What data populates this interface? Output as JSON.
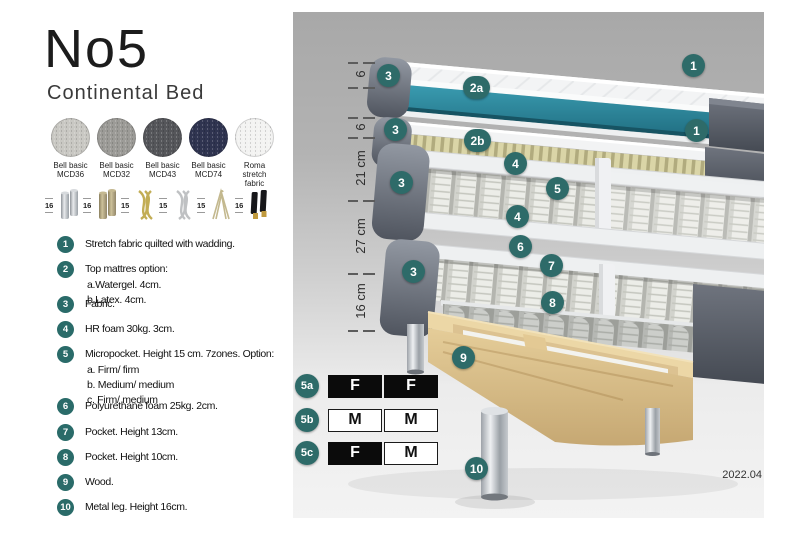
{
  "header": {
    "title": "No5",
    "subtitle": "Continental Bed"
  },
  "fabrics": {
    "items": [
      {
        "line1": "Bell basic",
        "line2": "MCD36",
        "color": "#c9c8c3"
      },
      {
        "line1": "Bell basic",
        "line2": "MCD32",
        "color": "#9c9b97"
      },
      {
        "line1": "Bell basic",
        "line2": "MCD43",
        "color": "#55565a"
      },
      {
        "line1": "Bell basic",
        "line2": "MCD74",
        "color": "#2f3450"
      },
      {
        "line1": "Roma",
        "line2": "stretch fabric",
        "color": "#f3f3f2"
      }
    ]
  },
  "legs": {
    "items": [
      {
        "height": "16",
        "style": "cylinder-silver"
      },
      {
        "height": "16",
        "style": "cylinder-brass"
      },
      {
        "height": "15",
        "style": "twisted-gold"
      },
      {
        "height": "15",
        "style": "twisted-silver"
      },
      {
        "height": "15",
        "style": "hairpin"
      },
      {
        "height": "16",
        "style": "black-gold-tip"
      }
    ]
  },
  "legend": {
    "items": [
      {
        "num": "1",
        "text": "Stretch fabric quilted with wadding."
      },
      {
        "num": "2",
        "text": "Top mattres option:",
        "subs": [
          "a.Watergel. 4cm.",
          "b.Latex. 4cm."
        ]
      },
      {
        "num": "3",
        "text": "Fabric."
      },
      {
        "num": "4",
        "text": "HR foam 30kg. 3cm."
      },
      {
        "num": "5",
        "text": "Micropocket. Height 15 cm. 7zones. Option:",
        "subs": [
          "a. Firm/ firm",
          "b. Medium/ medium",
          "c. Firm/ medium"
        ]
      },
      {
        "num": "6",
        "text": "Polyurethane foam 25kg. 2cm."
      },
      {
        "num": "7",
        "text": "Pocket. Height 13cm."
      },
      {
        "num": "8",
        "text": "Pocket. Height 10cm."
      },
      {
        "num": "9",
        "text": "Wood."
      },
      {
        "num": "10",
        "text": "Metal leg. Height 16cm."
      }
    ]
  },
  "diagram": {
    "measurements": [
      "6",
      "6",
      "21 cm",
      "27 cm",
      "16 cm"
    ],
    "callouts": [
      {
        "label": "3"
      },
      {
        "label": "2a"
      },
      {
        "label": "1"
      },
      {
        "label": "3"
      },
      {
        "label": "2b"
      },
      {
        "label": "1"
      },
      {
        "label": "4"
      },
      {
        "label": "5"
      },
      {
        "label": "3"
      },
      {
        "label": "4"
      },
      {
        "label": "6"
      },
      {
        "label": "7"
      },
      {
        "label": "3"
      },
      {
        "label": "8"
      },
      {
        "label": "9"
      },
      {
        "label": "10"
      }
    ],
    "firmness": {
      "rows": [
        {
          "label": "5a",
          "cells": [
            {
              "value": "F",
              "filled": true
            },
            {
              "value": "F",
              "filled": true
            }
          ]
        },
        {
          "label": "5b",
          "cells": [
            {
              "value": "M",
              "filled": false
            },
            {
              "value": "M",
              "filled": false
            }
          ]
        },
        {
          "label": "5c",
          "cells": [
            {
              "value": "F",
              "filled": true
            },
            {
              "value": "M",
              "filled": false
            }
          ]
        }
      ]
    },
    "version": "2022.04"
  },
  "colors": {
    "accent_teal": "#2e6b69",
    "watergel_teal": "#2a7f93",
    "latex_cream": "#d9d4a6",
    "bed_gray": "#5a5f69",
    "wood": "#e2cb98"
  }
}
